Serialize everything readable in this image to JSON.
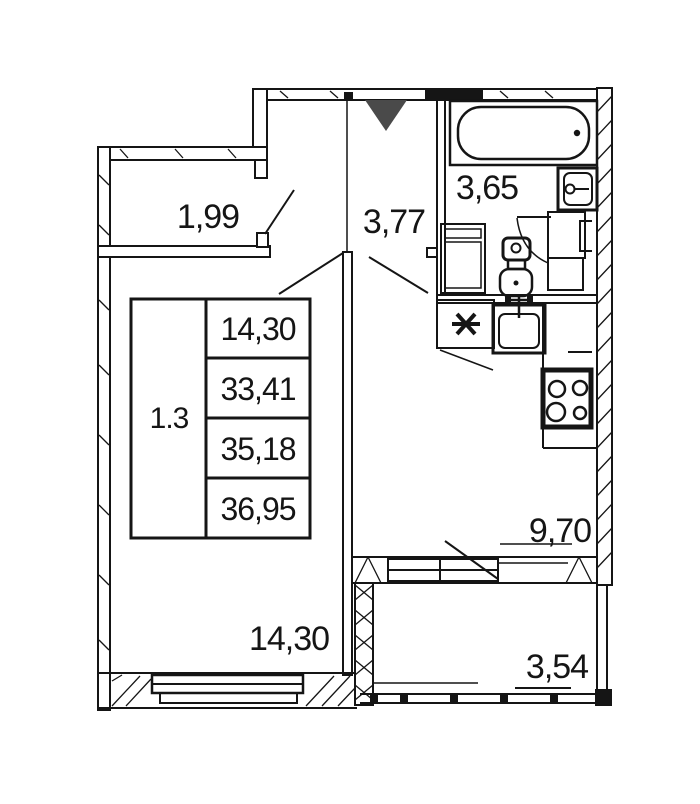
{
  "document": {
    "type": "apartment-floor-plan",
    "background": "#ffffff",
    "line_color": "#151515",
    "entrance_marker_color": "#4a4a4a"
  },
  "labels": {
    "wardrobe": "1,99",
    "hallway": "3,77",
    "bathroom": "3,65",
    "kitchen": "9,70",
    "living_room": "14,30",
    "balcony": "3,54"
  },
  "stamp": {
    "plan_code": "1.3",
    "rows": [
      "14,30",
      "33,41",
      "35,18",
      "36,95"
    ]
  },
  "icons": {
    "entrance-marker-icon": "filled-triangle-down",
    "bathtub-icon": "bathtub-top-view",
    "bathroom-sink-icon": "washbasin-top-view",
    "toilet-icon": "toilet-top-view",
    "washing-machine-icon": "appliance-square",
    "boiler-icon": "cabinet-with-bracket",
    "vent-shaft-icon": "asterisk",
    "kitchen-sink-icon": "sink-with-faucet",
    "stove-icon": "four-burner-stove",
    "window-icon": "double-frame-window",
    "door-swing-icon": "diagonal-leaf"
  }
}
